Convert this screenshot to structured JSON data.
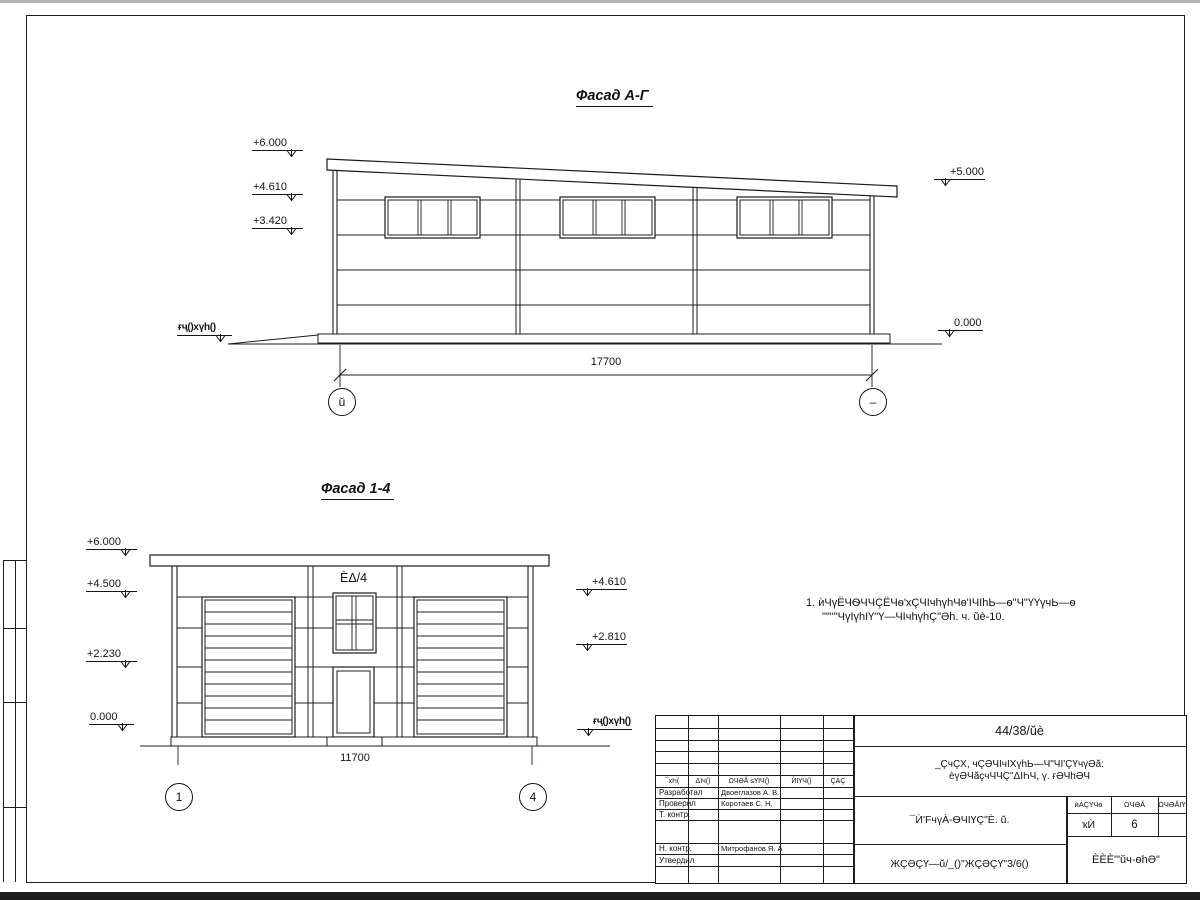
{
  "facade_ag": {
    "title": "Фасад А-Г",
    "levels_left": [
      "+6.000",
      "+4.610",
      "+3.420"
    ],
    "levels_right": [
      "+5.000",
      "0.000"
    ],
    "ground_label": "ғҷ()xүh()",
    "dimension": "17700",
    "axis_left": "ŭ",
    "axis_right": "–"
  },
  "facade_14": {
    "title": "Фасад 1-4",
    "levels_left": [
      "+6.000",
      "+4.500",
      "+2.230",
      "0.000"
    ],
    "levels_right": [
      "+4.610",
      "+2.810"
    ],
    "ground_label": "ғҷ()xүh()",
    "dimension": "11700",
    "axis_left": "1",
    "axis_right": "4",
    "window_label": "ÈΔ/4"
  },
  "note": {
    "line1": "1. ѝЧүЁЧѲЧЧÇЁЧѳ'хÇЧIчhүhЧѳ'IЧIhЬ—ѳ\"Ч\"ҮҮүчЬ—ѳ",
    "line2": "\"\"\"\"ЧүIүhIҮ\"Ү—ЧIчhүhÇ\"Әh. ч. ŭè-10."
  },
  "titleblock": {
    "doc_number": "44/38/ŭè",
    "header_cells": [
      "¯хҺ(",
      "ΔIч()",
      "ΩЧӘĂ ≤ҮIЧ()",
      "ЍIҮЧ()",
      "ÇȦÇ"
    ],
    "rows": [
      {
        "label": "Разработал",
        "name": "Двоеглазов А. В."
      },
      {
        "label": "Проверил",
        "name": "Коротаев С. Н."
      },
      {
        "label": "Т. контр.",
        "name": ""
      },
      {
        "label": "Н. контр.",
        "name": "Митрофанов Я. А."
      },
      {
        "label": "Утвердил",
        "name": ""
      }
    ],
    "project_line1": "_ÇчÇХ, чÇӘЧIчIХүhЬ—Ч\"ЧI'ÇҮчүӘă:",
    "project_line2": "èүӘЧăçчЧЧÇ\"ΔIҺЧ, ү. ғӘЧhӘЧ",
    "drawing_title": "¯Ѝ'FчүȦ-ѲЧIҮÇ\"È. ŭ.",
    "stage_headers": [
      "ѝȦÇҮЧѳ",
      "ΩЧӘĂ",
      "ΩЧӘĂIҮ"
    ],
    "stage_value": "ҡЍ",
    "sheet_number": "6",
    "sheets_total": "",
    "bottom_doc": "ЖÇӘÇҮ—ŭ/_()\"ЖÇӘÇҮ\"3/6()",
    "company": "ÈÈÈ'\"ŭч-ѳhӘ\""
  }
}
